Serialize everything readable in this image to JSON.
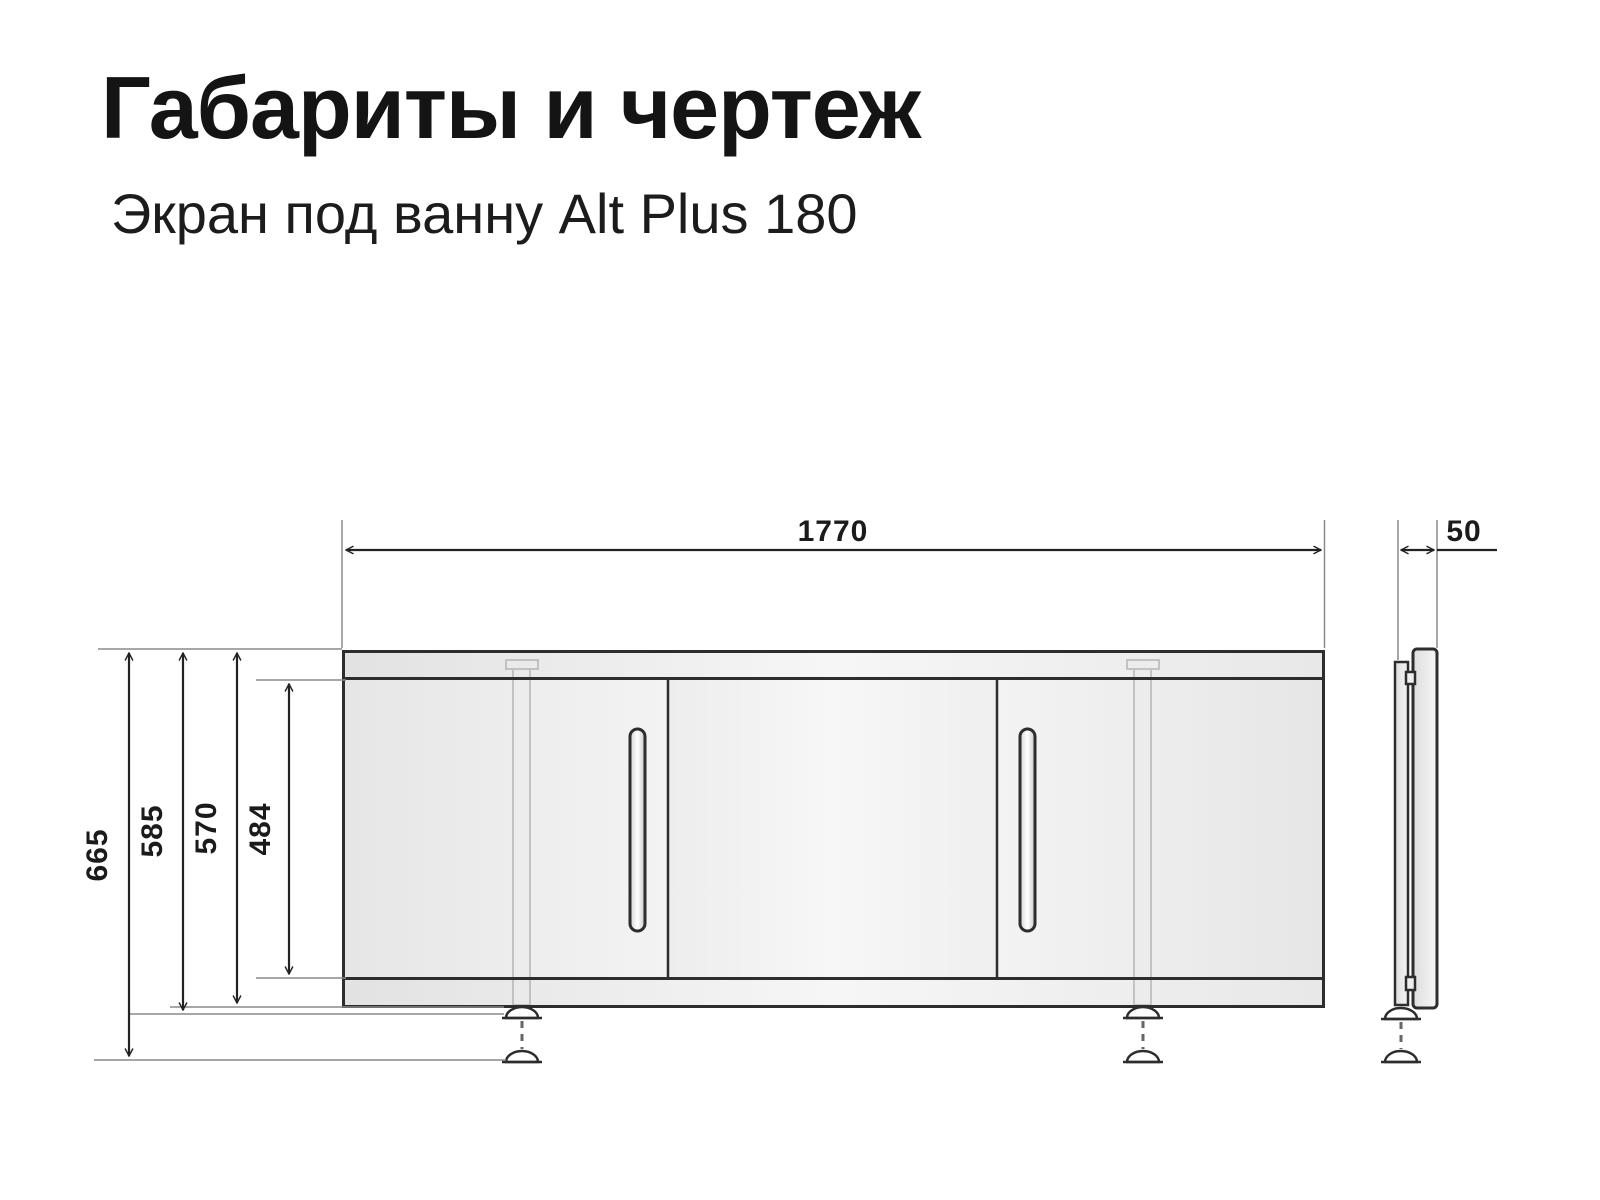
{
  "header": {
    "title": "Габариты и чертеж",
    "subtitle": "Экран под ванну Alt Plus 180"
  },
  "drawing": {
    "dim_labels": {
      "width": "1770",
      "depth": "50",
      "height_overall": "665",
      "height_to_foot": "585",
      "height_body": "570",
      "height_panel": "484"
    },
    "colors": {
      "outline": "#2d2d2d",
      "dimension": "#222222",
      "extension": "#8a8a8a",
      "panel_fill": "#efefef",
      "text": "#1b1b1b"
    }
  }
}
